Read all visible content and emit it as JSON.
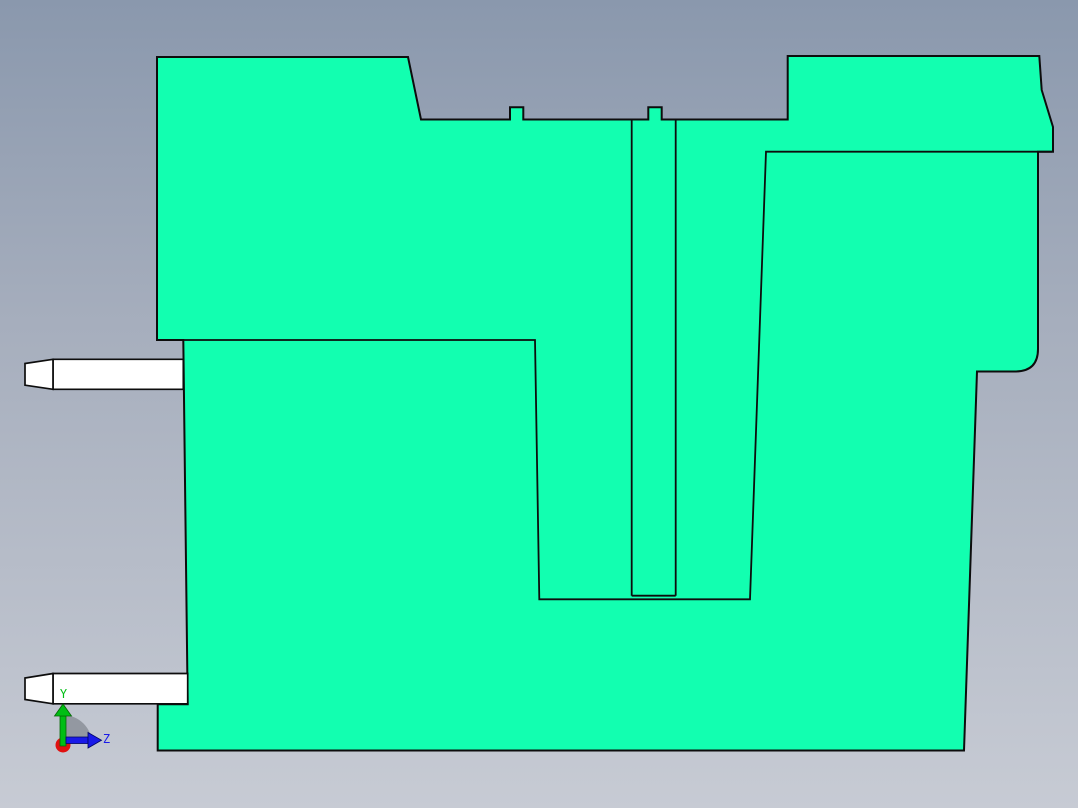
{
  "viewport": {
    "background_top": "#8A98AD",
    "background_mid": "#A6AEBD",
    "background_bottom": "#C7CBD4"
  },
  "part": {
    "fill": "#12FFB0",
    "edge": "#0D0D0D",
    "body_outline": "M 157,57 L 408,57 L 421,119.5 L 510,119.5 L 510,107.3 L 523.3,107.3 L 523.3,119.5 L 648.3,119.5 L 648.3,107.3 L 661.7,107.3 L 661.7,119.5 L 787.7,119.5 L 787.7,56 L 1039.3,56 L 1041.7,90 L 1053,127 L 1053,151.7 L 1038,151.7 L 1038,349 Q 1038,371.5 1015,371.5 L 977,371.5 L 964,750.5 L 157.7,750.5 L 157.7,704.3 L 187.7,704.3 L 183.3,340 L 157,340 Z",
    "seams": [
      "M 157,340 L 535,340 L 539.3,599.3 L 750,599.3 L 766,151.7 L 1052,151.7",
      "M 631.7,119.5 L 631.7,595.7",
      "M 675.7,119.5 L 675.7,595.7",
      "M 631.7,595.7 L 675.7,595.7"
    ]
  },
  "pins": {
    "fill": "#FFFFFF",
    "upper_tip": "M 53,359.3 L 25,363.5 L 25,385.2 L 53,389.3 Z",
    "upper_body": "M 53,359.3 L 183.3,359.3 L 183.3,389.3 L 53,389.3 Z",
    "lower_tip": "M 53,673.5 L 25,678 L 25,699.5 L 53,703.8 Z",
    "lower_body": "M 53,673.5 L 187.7,673.5 L 187.7,703.8 L 53,703.8 Z"
  },
  "axis_triad": {
    "y_label": "Y",
    "z_label": "Z",
    "y_color": "#00BE14",
    "y_dark": "#056605",
    "z_color": "#1A1AE8",
    "z_dark": "#000566",
    "origin_color": "#E01010",
    "sector_color": "rgba(110,115,122,0.55)",
    "paths": {
      "sector": "M 63,744 L 63,715 A 29,29 0 0 1 92,744 Z",
      "y_shaft": "M 60,716 L 66,716 L 66,746 L 60,746 Z",
      "y_head": "M 54.5,716 L 71.5,716 L 63,704 Z",
      "z_shaft": "M 66,737 L 88,737 L 88,743.5 L 66,743.5 Z",
      "z_head": "M 88,732.5 L 88,748 L 101.5,740.2 Z"
    }
  }
}
